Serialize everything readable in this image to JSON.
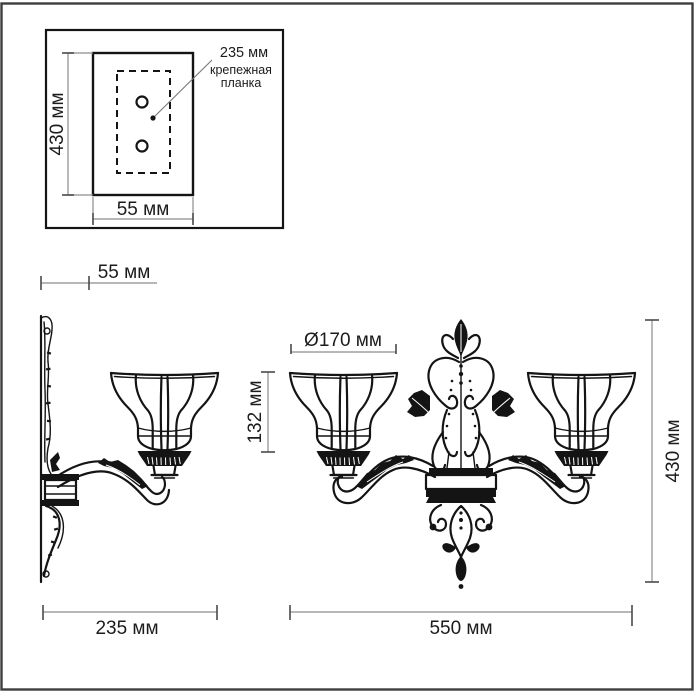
{
  "inset": {
    "height_label": "430 мм",
    "width_label": "55 мм",
    "callout": {
      "value": "235 мм",
      "label_line1": "крепежная",
      "label_line2": "планка"
    }
  },
  "dimensions": {
    "wall_depth": "55 мм",
    "shade_diameter": "Ø170 мм",
    "shade_height": "132 мм",
    "fixture_height": "430 мм",
    "side_depth": "235 мм",
    "fixture_width": "550 мм"
  },
  "colors": {
    "background": "#ffffff",
    "drawing": "#141414",
    "dimension_line": "#8c8c8c",
    "text": "#1c1c1c",
    "frame": "#3e3e3e"
  }
}
